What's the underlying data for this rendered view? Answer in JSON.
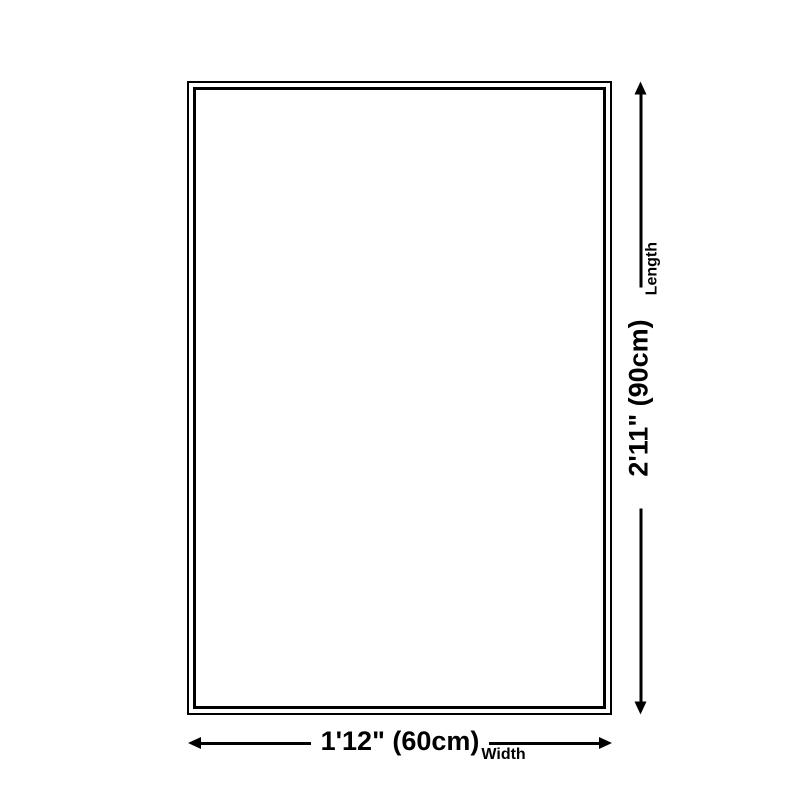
{
  "page": {
    "background_color": "#ffffff",
    "ink_color": "#000000"
  },
  "product_outline": {
    "shape": "rectangle-double-border"
  },
  "dimensions": {
    "width": {
      "value": "1'12\" (60cm)",
      "label": "Width"
    },
    "length": {
      "value": "2'11\" (90cm)",
      "label": "Length"
    }
  },
  "icons": {
    "width_arrow_left": "◄ solid triangle (css border shape)",
    "width_arrow_right": "► solid triangle (css border shape)",
    "length_arrow_up": "▲ solid triangle (css border shape)",
    "length_arrow_down": "▼ solid triangle (css border shape)"
  }
}
